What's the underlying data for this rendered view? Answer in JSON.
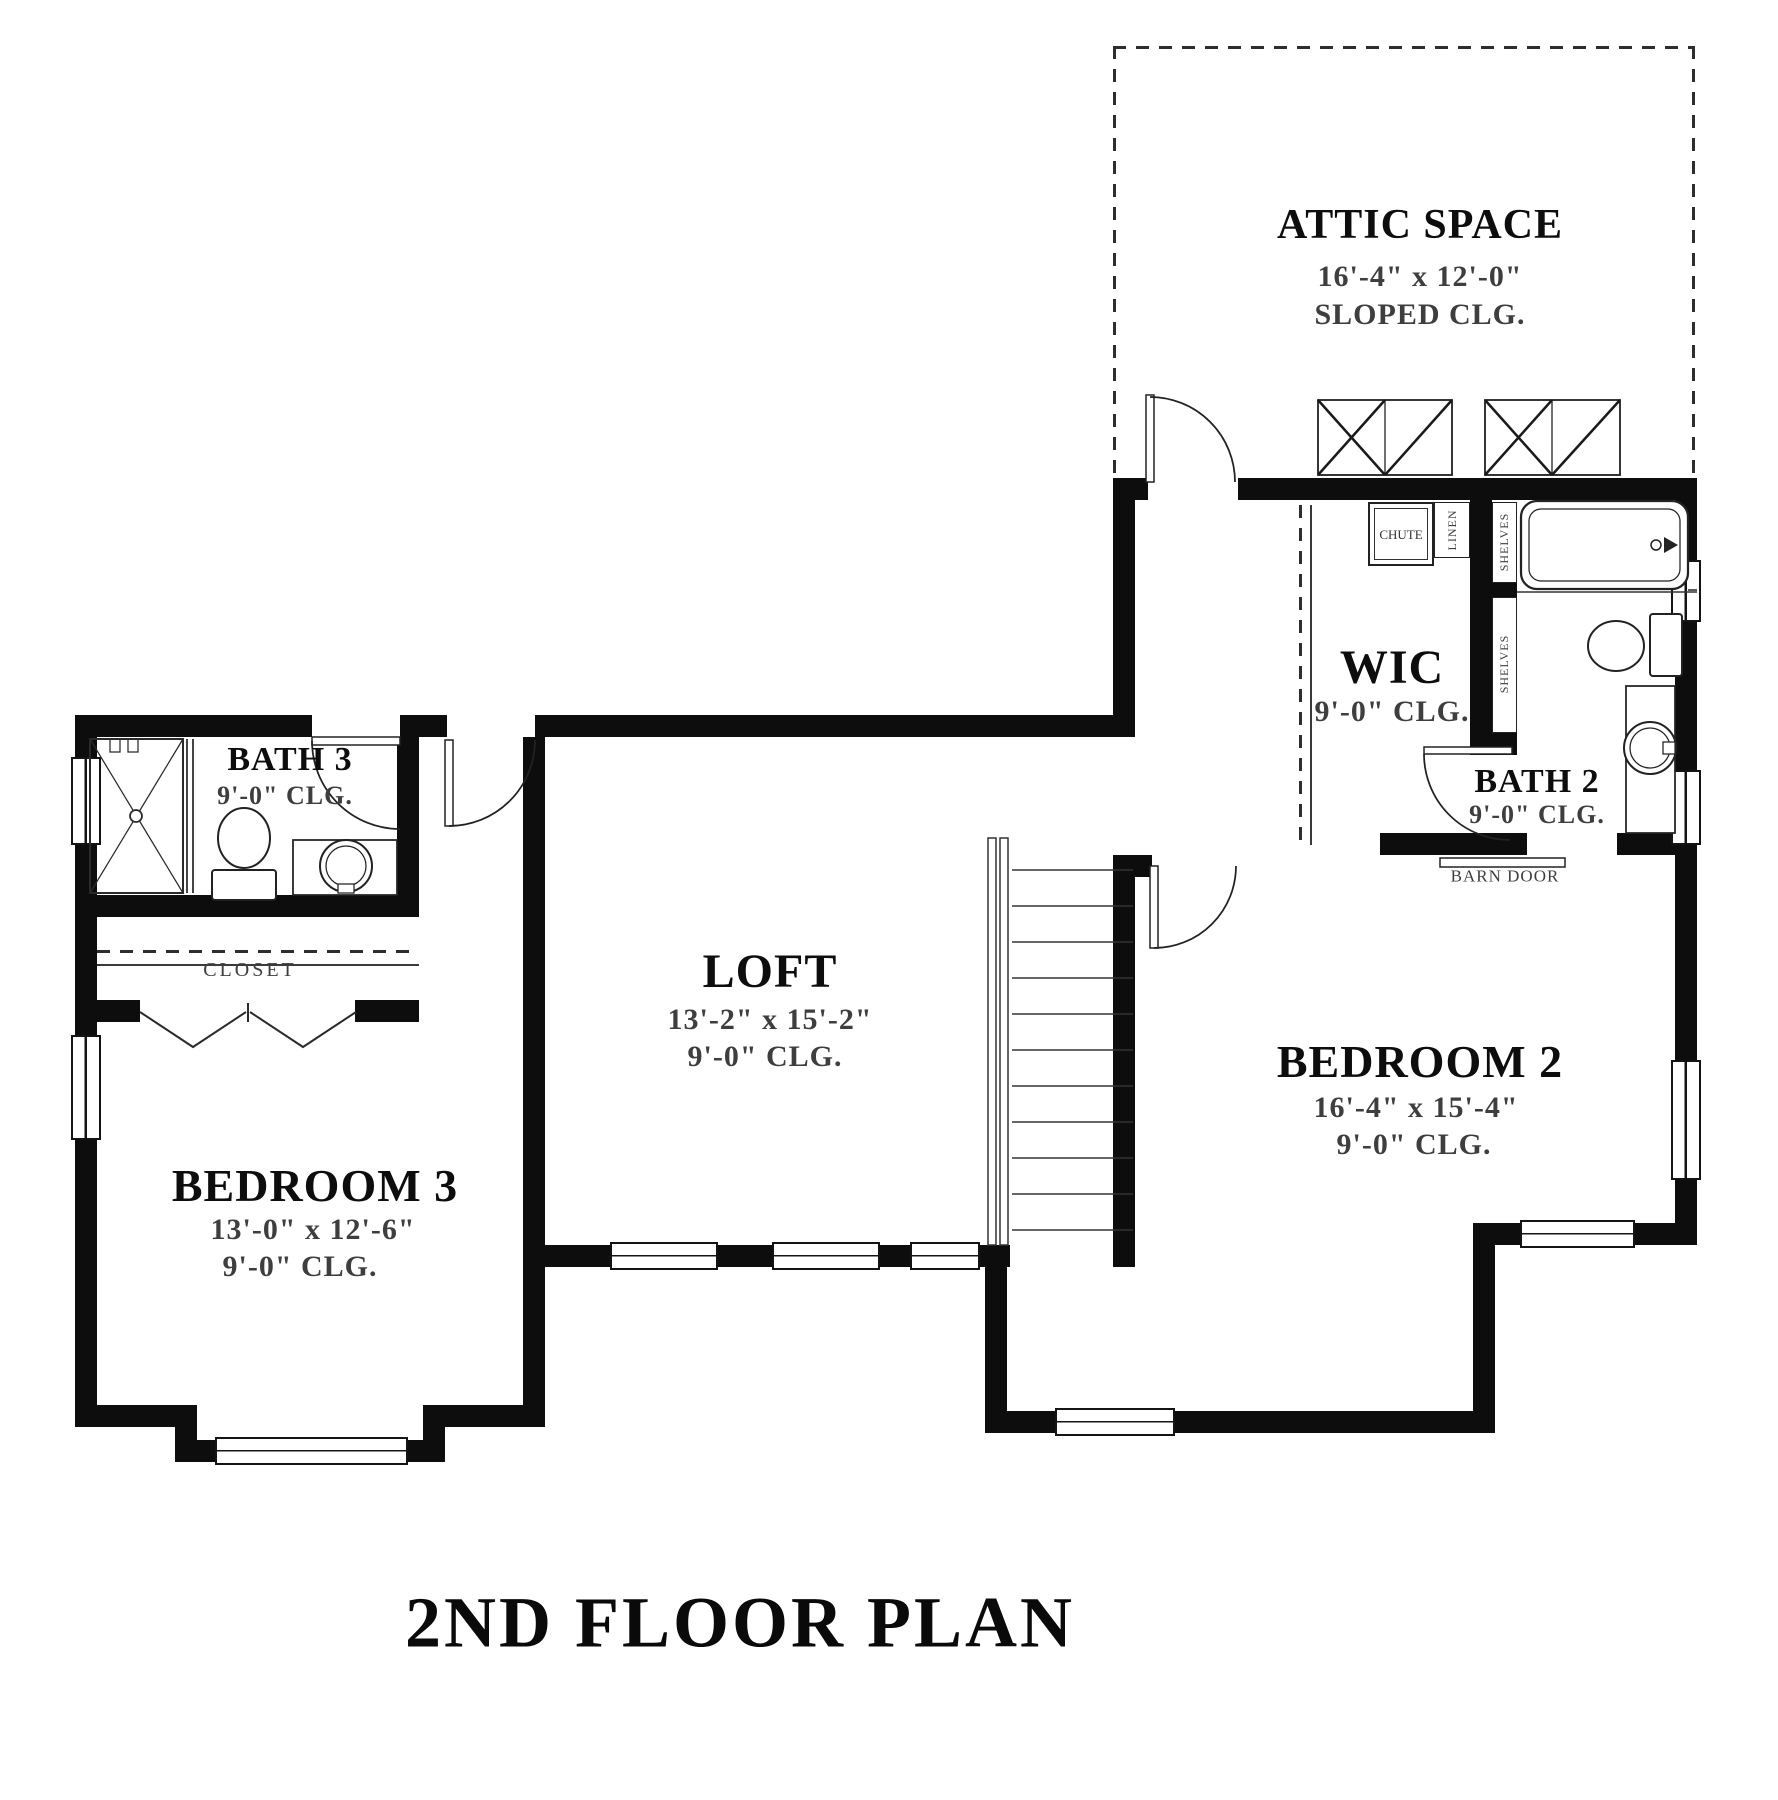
{
  "plan_title": "2ND FLOOR PLAN",
  "rooms": {
    "attic": {
      "name": "ATTIC SPACE",
      "dims": "16'-4\" x 12'-0\"",
      "ceiling": "SLOPED CLG."
    },
    "wic": {
      "name": "WIC",
      "ceiling": "9'-0\" CLG."
    },
    "bath2": {
      "name": "BATH 2",
      "ceiling": "9'-0\" CLG."
    },
    "bath3": {
      "name": "BATH 3",
      "ceiling": "9'-0\" CLG."
    },
    "loft": {
      "name": "LOFT",
      "dims": "13'-2\" x 15'-2\"",
      "ceiling": "9'-0\" CLG."
    },
    "bedroom2": {
      "name": "BEDROOM 2",
      "dims": "16'-4\" x 15'-4\"",
      "ceiling": "9'-0\" CLG."
    },
    "bedroom3": {
      "name": "BEDROOM 3",
      "dims": "13'-0\" x 12'-6\"",
      "ceiling": "9'-0\" CLG."
    },
    "closet": {
      "name": "CLOSET"
    }
  },
  "annotations": {
    "chute": "CHUTE",
    "linen": "LINEN",
    "shelves_upper": "SHELVES",
    "shelves_lower": "SHELVES",
    "barn_door": "BARN DOOR"
  },
  "colors": {
    "wall": "#0d0d0d",
    "line": "#222222",
    "dim_text": "#3e3e3e",
    "background": "#ffffff"
  }
}
